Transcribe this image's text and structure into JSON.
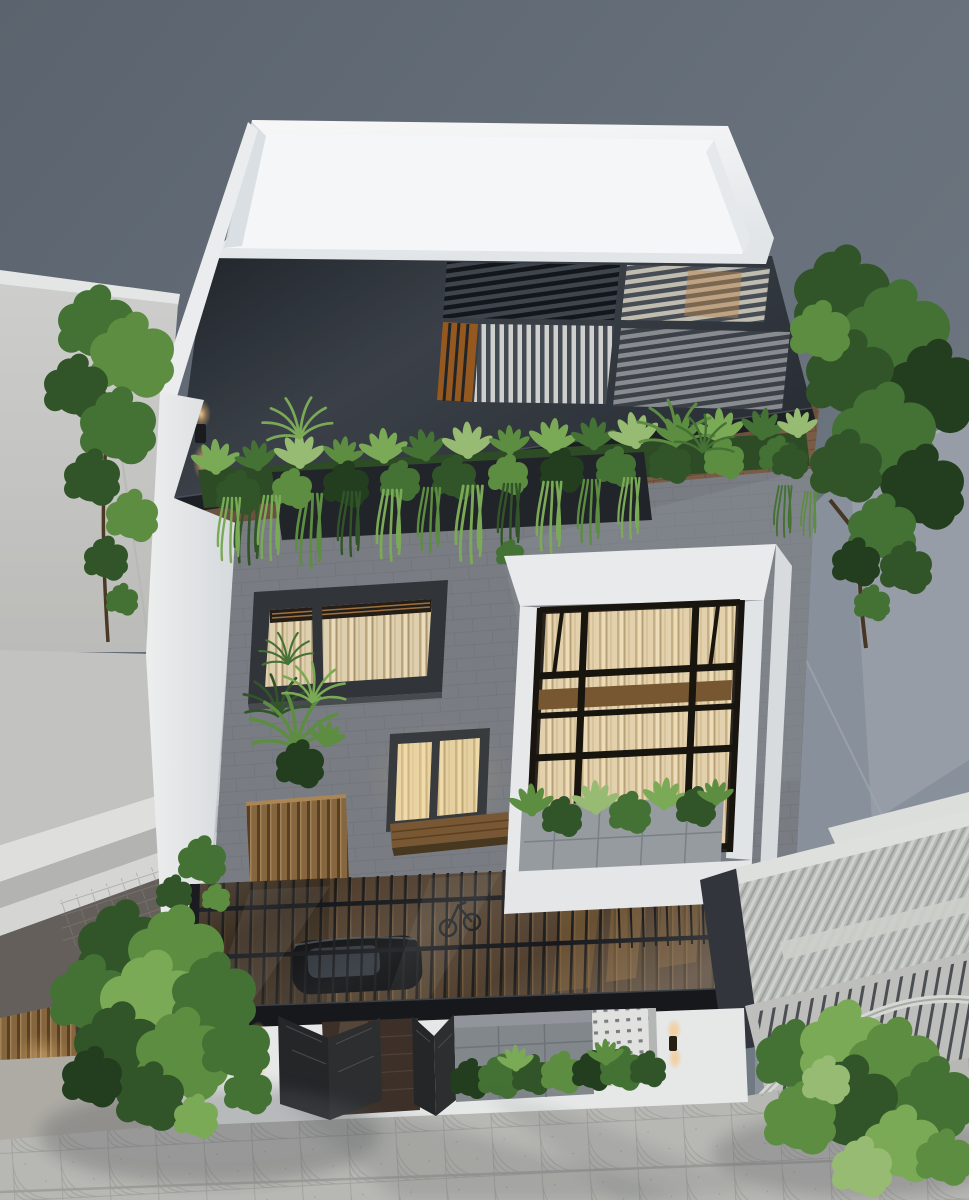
{
  "scene": {
    "title": "Aerial 3D architectural render of a modern multi-storey townhouse",
    "type": "architectural-visualization",
    "view": "bird's-eye three-quarter view from the street",
    "house_number": "88"
  },
  "palette": {
    "sky": "#6d7681",
    "roof_white": "#f3f6f7",
    "roof_dark": "#343a42",
    "facade_gray": "#7d8288",
    "bay_white": "#eef0f2",
    "curtain_warm": "#e8d8b6",
    "window_glow": "#f6e6c0",
    "foliage_dark": "#24401f",
    "foliage_mid": "#477536",
    "foliage_light": "#7fb05a",
    "wood": "#8a6a42",
    "canopy_glass": "#23262b",
    "pavement": "#bdbdb9",
    "neighbor_wall": "#cdcecb",
    "gate_metal": "#26282a"
  },
  "objects": {
    "rooftop": [
      "white parapet roof tray",
      "charcoal pergola deck with four louvered skylights",
      "warm-lit timber skylight",
      "outdoor dining table with chairs",
      "perimeter planter with tropical plants",
      "hanging ferns",
      "wall sconce"
    ],
    "middle_floors": [
      "grey brick facade",
      "wide curtained window",
      "small glowing two-pane window",
      "timber planter box with palms",
      "timber bench ledge",
      "white bay window with black mullion grid and curtains",
      "window-box greenery"
    ],
    "ground_floor": [
      "glass canopy over carport",
      "black car seen through glass",
      "bicycle",
      "open perforated steel gates",
      "house number plaque",
      "stone tile wall",
      "white breeze-block screen",
      "hedge shrubs",
      "wall lanterns"
    ],
    "surroundings": [
      "light-grey neighbouring houses",
      "corrugated metal roof",
      "arched entrance gate with railing",
      "street trees",
      "fan-patterned paver sidewalk",
      "soft tree shadows on pavement"
    ]
  }
}
